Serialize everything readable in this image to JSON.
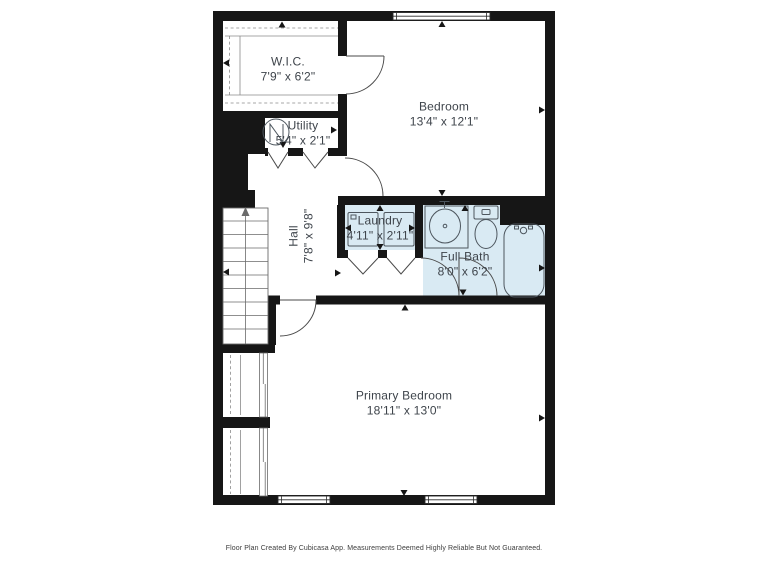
{
  "rooms": [
    {
      "id": "wic",
      "name": "W.I.C.",
      "dims": "7'9\" x 6'2\""
    },
    {
      "id": "bedroom",
      "name": "Bedroom",
      "dims": "13'4\" x 12'1\""
    },
    {
      "id": "utility",
      "name": "Utility",
      "dims": "5'4\" x 2'1\""
    },
    {
      "id": "hall",
      "name": "Hall",
      "dims": "7'8\" x 9'8\""
    },
    {
      "id": "laundry",
      "name": "Laundry",
      "dims": "4'11\" x 2'11\""
    },
    {
      "id": "full_bath",
      "name": "Full Bath",
      "dims": "8'0\" x 6'2\""
    },
    {
      "id": "primary_bedroom",
      "name": "Primary Bedroom",
      "dims": "18'11\" x 13'0\""
    }
  ],
  "fixtures": [
    "staircase-up-arrow",
    "water-heater",
    "washer",
    "dryer",
    "bathroom-sink",
    "toilet",
    "bathtub",
    "closet-rod",
    "sliding-closet-doors",
    "bifold-doors",
    "door-swings",
    "windows",
    "measurement-ticks"
  ],
  "footer": {
    "text": "Floor Plan Created By Cubicasa App. Measurements Deemed Highly Reliable But Not Guaranteed."
  },
  "colors": {
    "wall": "#161616",
    "wet_fill": "#d9eaf3",
    "label": "#3e444b",
    "fixture": "#4d565e",
    "footer": "#3d3d3d"
  }
}
